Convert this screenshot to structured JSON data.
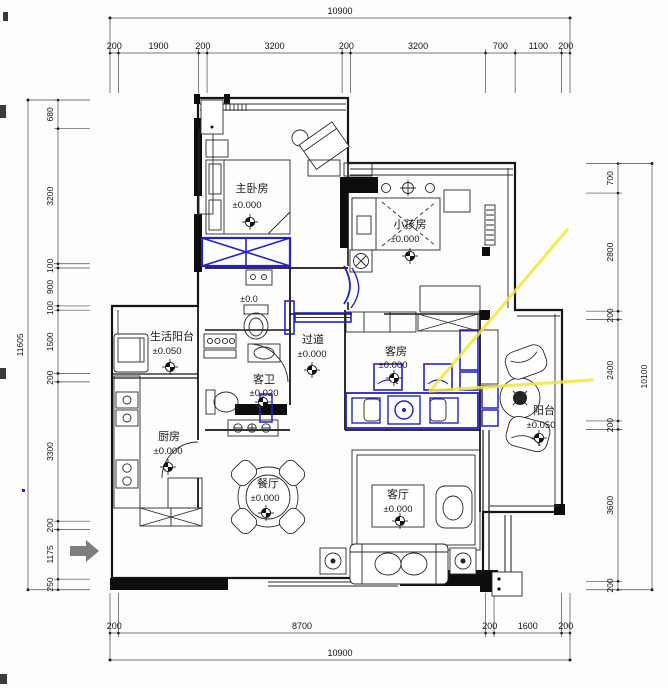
{
  "drawing": {
    "kind": "residential floor plan",
    "colors": {
      "highlight_blue": "#2222cc",
      "annotation_yellow": "#f4e63d",
      "wall_black": "#0d0d0d",
      "dim_line": "#4a4a4a",
      "entry_arrow_gray": "#7d7d7d"
    }
  },
  "dimensions": {
    "top": {
      "total": 10900,
      "segments": [
        200,
        1900,
        200,
        3200,
        200,
        3200,
        700,
        1100,
        200
      ]
    },
    "bottom": {
      "total": 10900,
      "segments": [
        200,
        8700,
        200,
        1600,
        200
      ]
    },
    "left": {
      "total": 11605,
      "segments": [
        680,
        3200,
        100,
        900,
        100,
        1500,
        200,
        3300,
        200,
        1175,
        250
      ]
    },
    "right": {
      "total": 10100,
      "segments": [
        700,
        2800,
        200,
        2400,
        200,
        3600,
        200
      ]
    }
  },
  "rooms": [
    {
      "id": "master-bedroom",
      "name": "主卧房",
      "level": "±0.000"
    },
    {
      "id": "kids-room",
      "name": "小孩房",
      "level": "±0.000"
    },
    {
      "id": "living-balcony",
      "name": "生活阳台",
      "level": "±0.050"
    },
    {
      "id": "hallway",
      "name": "过道",
      "level": "±0.000"
    },
    {
      "id": "guest-bath",
      "name": "客卫",
      "level": "±0.020"
    },
    {
      "id": "guest-room",
      "name": "客房",
      "level": "±0.000"
    },
    {
      "id": "kitchen",
      "name": "厨房",
      "level": "±0.000"
    },
    {
      "id": "dining-room",
      "name": "餐厅",
      "level": "±0.000"
    },
    {
      "id": "living-room",
      "name": "客厅",
      "level": "±0.000"
    },
    {
      "id": "balcony",
      "name": "阳台",
      "level": "±0.050"
    },
    {
      "id": "master-bath",
      "name": "",
      "level": "±0.0"
    }
  ]
}
